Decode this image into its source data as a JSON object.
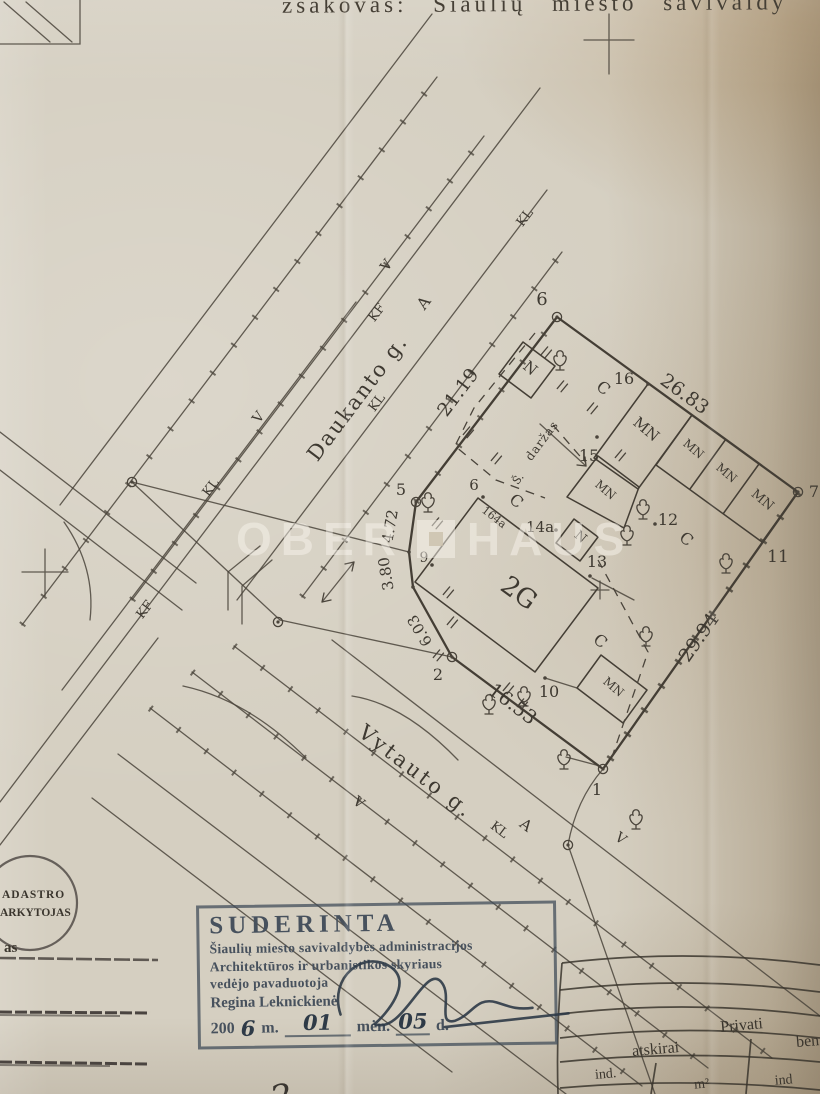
{
  "colors": {
    "paper": "#d5cfc1",
    "ink": "#4a443b",
    "stamp_ink": "#47515d",
    "table_ink": "#3a352d",
    "watermark": "#f7f4ec"
  },
  "header": {
    "top_line": "zsakovas:  Šiaulių  miesto  savivaldy"
  },
  "watermark": {
    "left": "OBER",
    "right": "HAUS"
  },
  "plan": {
    "streets": {
      "daukanto": "Daukanto g.",
      "vytauto": "Vytauto g."
    },
    "util": {
      "kl": "KL",
      "kf": "KF",
      "v": "V",
      "a": "A"
    },
    "dist": {
      "d2119": "21.19",
      "d2683": "26.83",
      "d2994": "29.94",
      "d1653": "16.53",
      "d472": "4.72",
      "d380": "3.80",
      "d603": "6.03"
    },
    "points": {
      "p1": "1",
      "p2": "2",
      "p5": "5",
      "p6": "6",
      "p7": "7",
      "p9": "9",
      "p10": "10",
      "p11": "11",
      "p12": "12",
      "p13": "13",
      "p14": "14a",
      "p15": "15",
      "p16": "16"
    },
    "areas": {
      "c": "C",
      "n": "N",
      "mn": "MN",
      "g2": "2G",
      "house": "164a",
      "garden": "daržas",
      "sh": "Š."
    }
  },
  "round_stamp": {
    "line1": "ADASTRO",
    "line2": "ARKYTOJAS",
    "note": "as"
  },
  "approval_stamp": {
    "title": "SUDERINTA",
    "line1": "Šiaulių miesto savivaldybės administracijos",
    "line2": "Architektūros ir urbanistikos skyriaus",
    "line3": "vedėjo pavaduotoja",
    "name": "Regina Leknickienė",
    "year_prefix": "200",
    "year_hand": "6",
    "m_label": "m.",
    "month_hand": "01",
    "men_label": "mėn.",
    "day_hand": "05",
    "d_label": "d."
  },
  "table": {
    "privati": "Privati",
    "atskirai": "atskirai",
    "bendrai": "ben",
    "ind_left": "ind.",
    "m2": "m²",
    "ind_right": "ind"
  },
  "hand_note": {
    "text": "2"
  }
}
